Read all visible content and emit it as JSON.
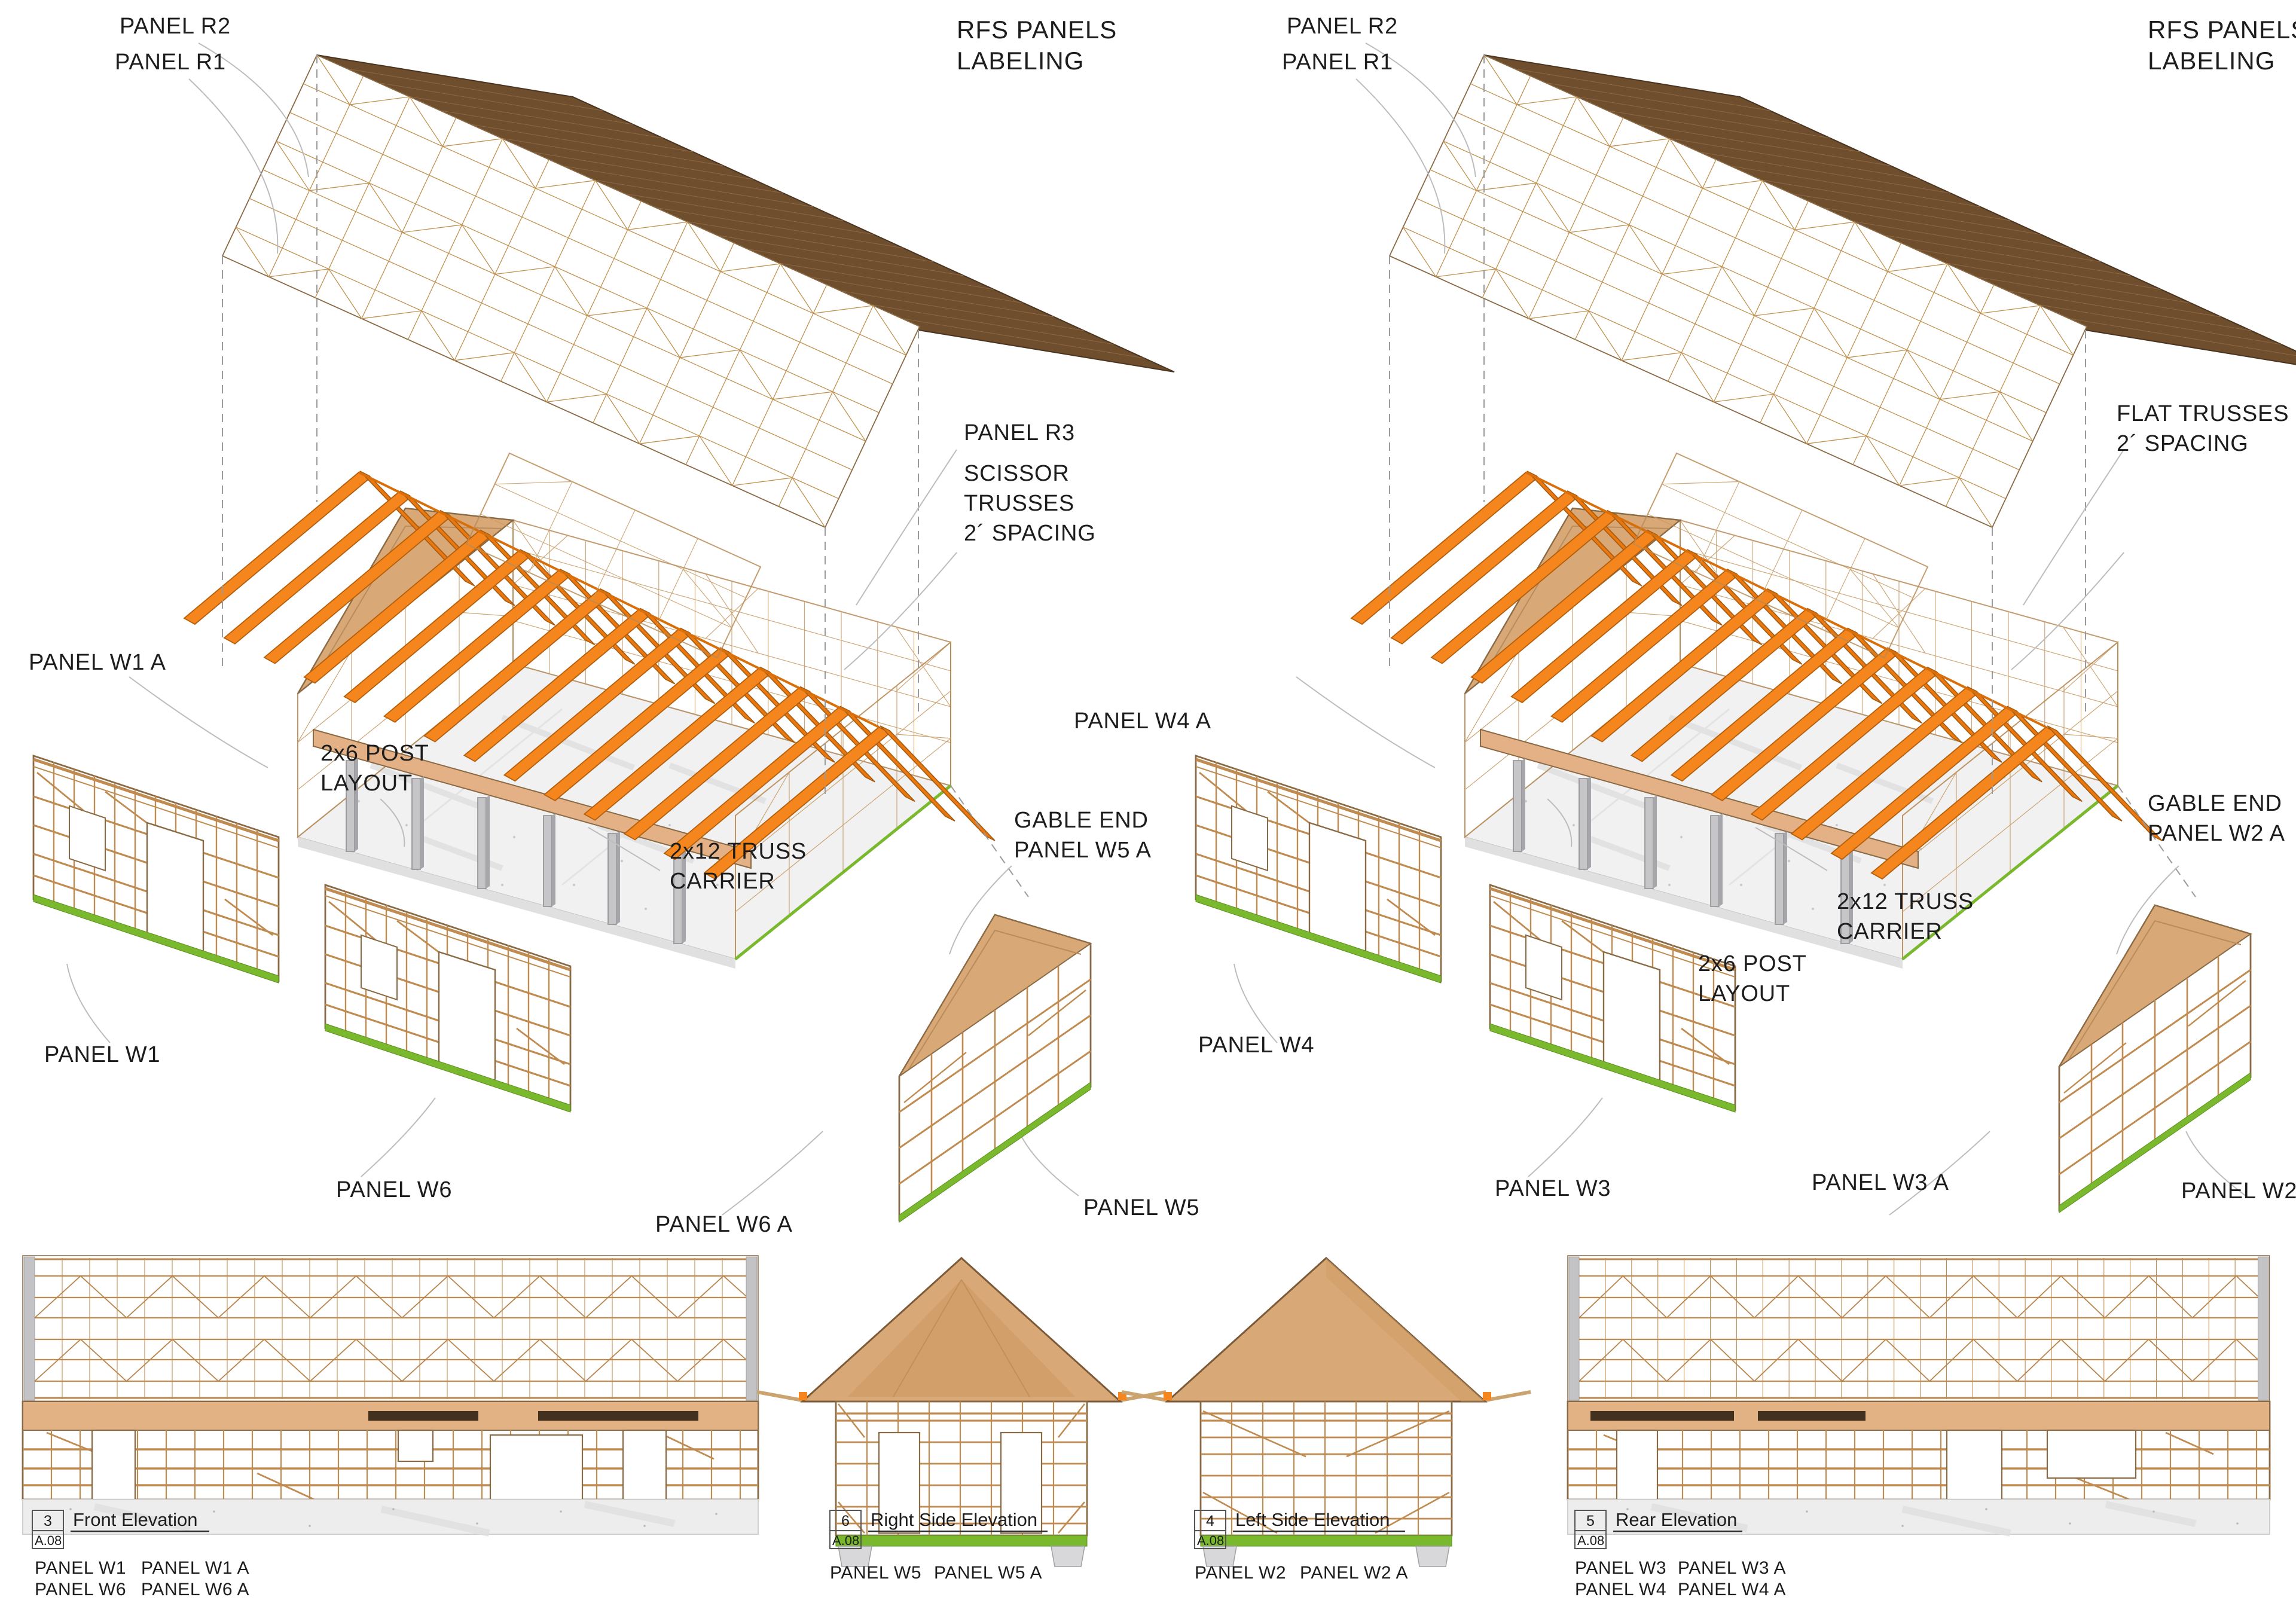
{
  "sheet_heading": "RFS PANELS LABELING",
  "left_view": {
    "panel_r2": "PANEL R2",
    "panel_r1": "PANEL R1",
    "heading_line1": "RFS PANELS",
    "heading_line2": "LABELING",
    "panel_r3": "PANEL R3",
    "truss_note_line1": "SCISSOR",
    "truss_note_line2": "TRUSSES",
    "truss_note_line3": "2´ SPACING",
    "panel_w1a": "PANEL W1 A",
    "post_note_line1": "2x6 POST",
    "post_note_line2": "LAYOUT",
    "carrier_note_line1": "2x12 TRUSS",
    "carrier_note_line2": "CARRIER",
    "gable_note_line1": "GABLE END",
    "gable_note_line2": "PANEL W5 A",
    "panel_w1": "PANEL W1",
    "panel_w6": "PANEL W6",
    "panel_w6a": "PANEL W6 A",
    "panel_w5": "PANEL W5"
  },
  "right_view": {
    "panel_r2": "PANEL R2",
    "panel_r1": "PANEL R1",
    "heading_line1": "RFS PANELS",
    "heading_line2": "LABELING",
    "truss_note_line1": "FLAT TRUSSES",
    "truss_note_line2": "2´ SPACING",
    "panel_w4a": "PANEL W4 A",
    "gable_note_line1": "GABLE END",
    "gable_note_line2": "PANEL W2 A",
    "carrier_note_line1": "2x12 TRUSS",
    "carrier_note_line2": "CARRIER",
    "post_note_line1": "2x6 POST",
    "post_note_line2": "LAYOUT",
    "panel_w4": "PANEL W4",
    "panel_w3": "PANEL W3",
    "panel_w3a": "PANEL W3 A",
    "panel_w2": "PANEL W2"
  },
  "elevations": {
    "front": {
      "num": "3",
      "title": "Front Elevation",
      "sheet": "A.08",
      "cap_r1c1": "PANEL W1",
      "cap_r2c1": "PANEL W6",
      "cap_r1c2": "PANEL W1 A",
      "cap_r2c2": "PANEL W6 A"
    },
    "right_side": {
      "num": "6",
      "title": "Right Side Elevation",
      "sheet": "A.08",
      "cap_c1": "PANEL W5",
      "cap_c2": "PANEL W5 A"
    },
    "left_side": {
      "num": "4",
      "title": "Left Side Elevation",
      "sheet": "A.08",
      "cap_c1": "PANEL W2",
      "cap_c2": "PANEL W2 A"
    },
    "rear": {
      "num": "5",
      "title": "Rear Elevation",
      "sheet": "A.08",
      "cap_r1c1": "PANEL W3",
      "cap_r2c1": "PANEL W4",
      "cap_r1c2": "PANEL W3 A",
      "cap_r2c2": "PANEL W4 A"
    }
  },
  "colors": {
    "truss_orange": "#f5861e",
    "wood_line": "#c0914f",
    "wood_outline": "#8a6a44",
    "roof_far_side": "#6f4e2e",
    "sheathing_tan": "#d9a877",
    "sill_green": "#7ab82e",
    "post_gray": "#c6c6c9",
    "slab_gray": "#f1f1f1",
    "text": "#1d1d1e"
  }
}
